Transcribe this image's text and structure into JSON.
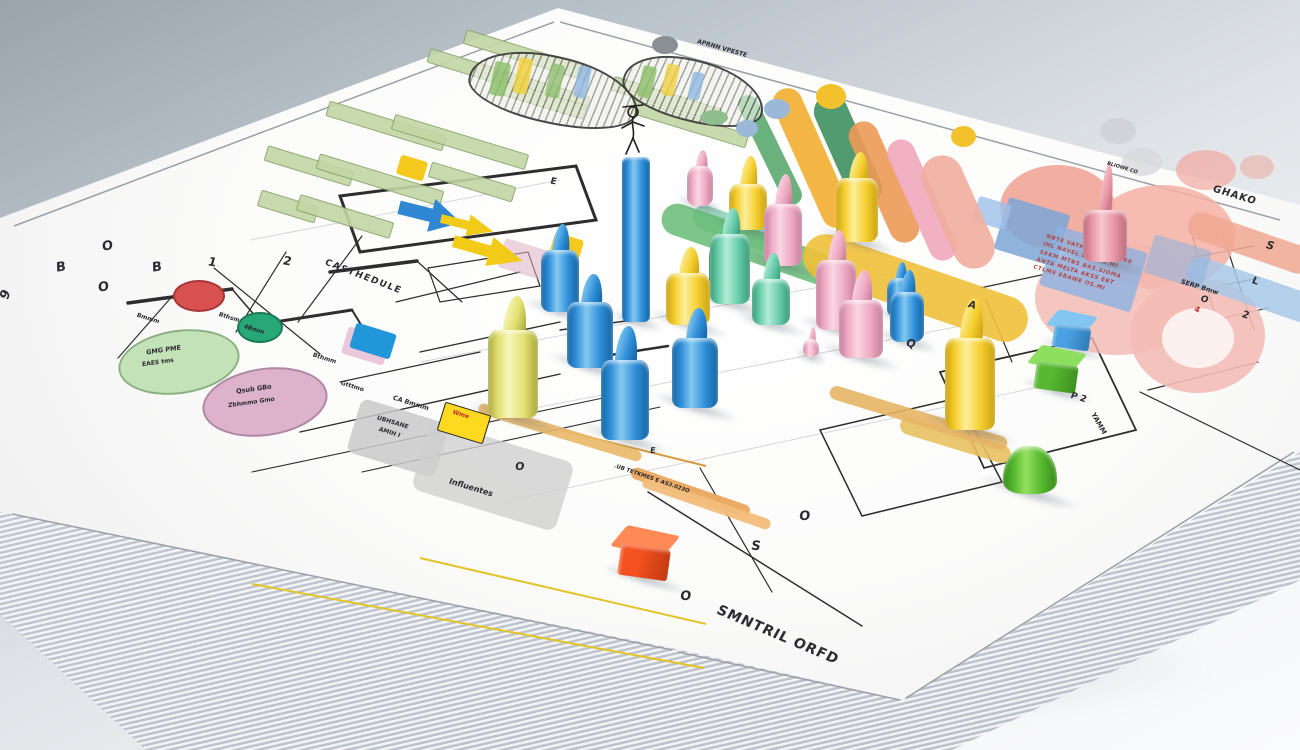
{
  "scene": {
    "description": "3D render of a stack of white papers printed with colorful project charts, Gantt bars, flowcharts and pink data blobs, covered with glossy plastic game pegs and cubes",
    "background_top": "#9aa4ad",
    "background_bottom": "#fafbfc",
    "paper_color": "#fcfcfb"
  },
  "palettes": {
    "blue": {
      "b": "#2f8fd9",
      "l": "#85c8f0",
      "d": "#1563a0"
    },
    "yellow": {
      "b": "#f5cf2e",
      "l": "#fcee9a",
      "d": "#c9a113"
    },
    "yellow2": {
      "b": "#e3e070",
      "l": "#f6f6bc",
      "d": "#aaa83e"
    },
    "pink": {
      "b": "#eeaac2",
      "l": "#fad6e2",
      "d": "#c27e9a"
    },
    "salmon": {
      "b": "#e895a5",
      "l": "#f6c6d0",
      "d": "#b86a7c"
    },
    "green": {
      "b": "#66ccaa",
      "l": "#b4ecd8",
      "d": "#3a9874"
    },
    "green2": {
      "b": "#3aa864",
      "l": "#82d4a2",
      "d": "#1f7a42"
    },
    "green3": {
      "b": "#55b82e",
      "l": "#96e060",
      "d": "#3a8c1c"
    }
  },
  "labels": [
    {
      "t": "O",
      "x": 102,
      "y": 240,
      "r": -8,
      "s": 13
    },
    {
      "t": "B",
      "x": 56,
      "y": 261,
      "r": -8,
      "s": 13
    },
    {
      "t": "B",
      "x": 152,
      "y": 261,
      "r": -8,
      "s": 13
    },
    {
      "t": "O",
      "x": 98,
      "y": 281,
      "r": -8,
      "s": 13
    },
    {
      "t": "9",
      "x": 2,
      "y": 288,
      "r": -70,
      "s": 13
    },
    {
      "t": "2",
      "x": 283,
      "y": 255,
      "r": 10,
      "s": 12
    },
    {
      "t": "1",
      "x": 208,
      "y": 256,
      "r": 10,
      "s": 12
    },
    {
      "t": "CASTHEDULE",
      "x": 322,
      "y": 273,
      "r": 21,
      "s": 9,
      "ls": 1.5
    },
    {
      "t": "Bmmm",
      "x": 136,
      "y": 316,
      "r": 17,
      "s": 6
    },
    {
      "t": "Bthsm",
      "x": 218,
      "y": 315,
      "r": 17,
      "s": 6
    },
    {
      "t": "4Bmm",
      "x": 243,
      "y": 327,
      "r": 17,
      "s": 6
    },
    {
      "t": "Bthmm",
      "x": 312,
      "y": 356,
      "r": 17,
      "s": 6
    },
    {
      "t": "Gtttmo",
      "x": 340,
      "y": 384,
      "r": 17,
      "s": 6
    },
    {
      "t": "GMG PME",
      "x": 146,
      "y": 347,
      "r": -8,
      "s": 6.5
    },
    {
      "t": "EAES tms",
      "x": 142,
      "y": 360,
      "r": -8,
      "s": 6
    },
    {
      "t": "Qsub GBo",
      "x": 236,
      "y": 386,
      "r": -8,
      "s": 6.5
    },
    {
      "t": "Zbhmmo Gmo",
      "x": 228,
      "y": 400,
      "r": -8,
      "s": 6
    },
    {
      "t": "CA Bmmm",
      "x": 392,
      "y": 400,
      "r": 17,
      "s": 6.5
    },
    {
      "t": "UBHSANE",
      "x": 376,
      "y": 420,
      "r": 17,
      "s": 6
    },
    {
      "t": "AMIH I",
      "x": 378,
      "y": 430,
      "r": 17,
      "s": 6
    },
    {
      "t": "Influentes",
      "x": 448,
      "y": 484,
      "r": 17,
      "s": 8
    },
    {
      "t": "O",
      "x": 515,
      "y": 461,
      "r": 0,
      "s": 11
    },
    {
      "t": "E",
      "x": 550,
      "y": 178,
      "r": 10,
      "s": 9
    },
    {
      "t": "APRNN VPESTE",
      "x": 696,
      "y": 46,
      "r": 16,
      "s": 6
    },
    {
      "t": ".UB TETKMES E AS3.023O",
      "x": 612,
      "y": 476,
      "r": 19,
      "s": 5.5
    },
    {
      "t": "E",
      "x": 650,
      "y": 447,
      "r": 0,
      "s": 8
    },
    {
      "t": "O",
      "x": 680,
      "y": 590,
      "r": 0,
      "s": 13
    },
    {
      "t": "S",
      "x": 751,
      "y": 540,
      "r": 5,
      "s": 13
    },
    {
      "t": "O",
      "x": 799,
      "y": 510,
      "r": 0,
      "s": 13
    },
    {
      "t": "SMNTRIL ORFD",
      "x": 712,
      "y": 628,
      "r": 23,
      "s": 14,
      "ls": 1
    },
    {
      "t": "Q",
      "x": 906,
      "y": 338,
      "r": 15,
      "s": 11
    },
    {
      "t": "A",
      "x": 968,
      "y": 300,
      "r": 15,
      "s": 10
    },
    {
      "t": "GHAKO",
      "x": 1212,
      "y": 190,
      "r": 17,
      "s": 10,
      "ls": 1
    },
    {
      "t": "BLIOWE CO",
      "x": 1106,
      "y": 166,
      "r": 17,
      "s": 5
    },
    {
      "t": "SERP Bmw",
      "x": 1180,
      "y": 284,
      "r": 17,
      "s": 6.5
    },
    {
      "t": "S",
      "x": 1266,
      "y": 240,
      "r": 17,
      "s": 11
    },
    {
      "t": "L",
      "x": 1252,
      "y": 276,
      "r": 17,
      "s": 10
    },
    {
      "t": "2",
      "x": 1242,
      "y": 310,
      "r": 17,
      "s": 10
    },
    {
      "t": "O",
      "x": 1200,
      "y": 296,
      "r": 17,
      "s": 9
    },
    {
      "t": "4",
      "x": 1194,
      "y": 306,
      "r": 17,
      "s": 8,
      "c": "#c03030"
    },
    {
      "t": "P 2",
      "x": 1070,
      "y": 394,
      "r": 17,
      "s": 9
    },
    {
      "t": "YAMM",
      "x": 1086,
      "y": 420,
      "r": 60,
      "s": 7
    },
    {
      "t": "Wme",
      "x": 452,
      "y": 412,
      "r": 17,
      "s": 6,
      "c": "#b83030"
    }
  ],
  "red_table": {
    "x": 1028,
    "y": 252,
    "w": 152,
    "h": 84,
    "r": 17,
    "rows": [
      "NBTE VATMOS OF SAMKE",
      "IHL NAVEL NVO TS.MI",
      "SEKM MTBS BAS.SIOMA",
      "ANTA MELTA AKSS EBT",
      "CTLMS EBAWE OS.MI"
    ]
  },
  "shapes": [
    {
      "T": "ell",
      "x": 1000,
      "y": 165,
      "w": 115,
      "h": 85,
      "c": "#f0a090",
      "o": 0.85
    },
    {
      "T": "ell",
      "x": 1090,
      "y": 185,
      "w": 145,
      "h": 105,
      "c": "#f4b0a4",
      "o": 0.85
    },
    {
      "T": "ell",
      "x": 1035,
      "y": 240,
      "w": 165,
      "h": 115,
      "c": "#f2b8b0",
      "o": 0.8
    },
    {
      "T": "ell",
      "x": 1130,
      "y": 278,
      "w": 135,
      "h": 115,
      "c": "#f4bcb6",
      "o": 0.9
    },
    {
      "T": "ell",
      "x": 1162,
      "y": 308,
      "w": 72,
      "h": 60,
      "c": "#fdf3f2",
      "o": 0.95
    },
    {
      "T": "ell",
      "x": 1176,
      "y": 150,
      "w": 60,
      "h": 40,
      "c": "#f2a8a0",
      "o": 0.7
    },
    {
      "T": "ell",
      "x": 1122,
      "y": 148,
      "w": 40,
      "h": 28,
      "c": "#d8d8dc",
      "o": 0.8
    },
    {
      "T": "ell",
      "x": 1100,
      "y": 118,
      "w": 36,
      "h": 26,
      "c": "#cfcfd4",
      "o": 0.8
    },
    {
      "T": "ell",
      "x": 1240,
      "y": 155,
      "w": 34,
      "h": 24,
      "c": "#e8b8b0",
      "o": 0.7
    },
    {
      "T": "cap",
      "x": 1250,
      "y": 243,
      "l": 130,
      "t": 28,
      "r": 19,
      "c": "#f0a890",
      "o": 0.85
    },
    {
      "T": "cap",
      "x": 1258,
      "y": 292,
      "l": 150,
      "t": 30,
      "r": 19,
      "c": "#a8c8e8",
      "o": 0.85
    },
    {
      "T": "rect",
      "x": 1000,
      "y": 205,
      "w": 64,
      "h": 54,
      "r": 17,
      "c": "#7ca6d6",
      "o": 0.85
    },
    {
      "T": "rect",
      "x": 1046,
      "y": 238,
      "w": 95,
      "h": 62,
      "r": 17,
      "c": "#8cb2e2",
      "o": 0.8
    },
    {
      "T": "rect",
      "x": 975,
      "y": 200,
      "w": 34,
      "h": 26,
      "r": 17,
      "c": "#9ec0e8",
      "o": 0.8
    },
    {
      "T": "rect",
      "x": 1148,
      "y": 242,
      "w": 60,
      "h": 40,
      "r": 17,
      "c": "#92b4dc",
      "o": 0.6
    },
    {
      "T": "cap",
      "x": 770,
      "y": 150,
      "l": 120,
      "t": 20,
      "r": 64,
      "c": "#5aa96f",
      "o": 0.9
    },
    {
      "T": "cap",
      "x": 812,
      "y": 158,
      "l": 150,
      "t": 30,
      "r": 66,
      "c": "#f2b23a",
      "o": 0.95
    },
    {
      "T": "cap",
      "x": 848,
      "y": 150,
      "l": 118,
      "t": 34,
      "r": 66,
      "c": "#3f8f5f",
      "o": 0.9
    },
    {
      "T": "cap",
      "x": 884,
      "y": 182,
      "l": 130,
      "t": 30,
      "r": 66,
      "c": "#ec9a57",
      "o": 0.9
    },
    {
      "T": "cap",
      "x": 922,
      "y": 200,
      "l": 130,
      "t": 28,
      "r": 66,
      "c": "#f0a8bc",
      "o": 0.9
    },
    {
      "T": "cap",
      "x": 958,
      "y": 212,
      "l": 120,
      "t": 42,
      "r": 66,
      "c": "#efae9e",
      "o": 0.9
    },
    {
      "T": "cap",
      "x": 745,
      "y": 232,
      "l": 110,
      "t": 24,
      "r": 20,
      "c": "#8fd0b8",
      "o": 0.85
    },
    {
      "T": "cap",
      "x": 757,
      "y": 247,
      "l": 200,
      "t": 32,
      "r": 19,
      "c": "#66bb73",
      "o": 0.85
    },
    {
      "T": "cap",
      "x": 915,
      "y": 288,
      "l": 235,
      "t": 46,
      "r": 19,
      "c": "#f0c03a",
      "o": 0.9
    },
    {
      "T": "cap",
      "x": 955,
      "y": 440,
      "l": 115,
      "t": 18,
      "r": 17,
      "c": "#e8c060",
      "o": 0.9
    },
    {
      "T": "cap",
      "x": 918,
      "y": 418,
      "l": 185,
      "t": 14,
      "r": 17,
      "c": "#e7b565",
      "o": 0.9
    },
    {
      "T": "cap",
      "x": 690,
      "y": 492,
      "l": 125,
      "t": 12,
      "r": 19,
      "c": "#eaa75c",
      "o": 0.95
    },
    {
      "T": "cap",
      "x": 706,
      "y": 503,
      "l": 135,
      "t": 11,
      "r": 19,
      "c": "#f2bd7a",
      "o": 0.95
    },
    {
      "T": "cap",
      "x": 560,
      "y": 432,
      "l": 170,
      "t": 11,
      "r": 17,
      "c": "#eab868",
      "o": 0.9
    },
    {
      "T": "bar",
      "x": 462,
      "y": 48,
      "w": 128,
      "h": 13
    },
    {
      "T": "bar",
      "x": 425,
      "y": 72,
      "w": 165,
      "h": 13
    },
    {
      "T": "bar",
      "x": 497,
      "y": 92,
      "w": 88,
      "h": 13
    },
    {
      "T": "bar",
      "x": 325,
      "y": 118,
      "w": 120,
      "h": 14
    },
    {
      "T": "bar",
      "x": 390,
      "y": 134,
      "w": 138,
      "h": 14
    },
    {
      "T": "bar",
      "x": 264,
      "y": 158,
      "w": 88,
      "h": 14
    },
    {
      "T": "bar",
      "x": 315,
      "y": 172,
      "w": 128,
      "h": 14
    },
    {
      "T": "bar",
      "x": 428,
      "y": 174,
      "w": 86,
      "h": 14
    },
    {
      "T": "bar",
      "x": 258,
      "y": 198,
      "w": 58,
      "h": 15
    },
    {
      "T": "bar",
      "x": 296,
      "y": 208,
      "w": 96,
      "h": 15
    },
    {
      "T": "bar",
      "x": 610,
      "y": 92,
      "w": 110,
      "h": 13
    },
    {
      "T": "bar",
      "x": 628,
      "y": 116,
      "w": 120,
      "h": 13
    },
    {
      "T": "hatch",
      "x": 468,
      "y": 56,
      "w": 168,
      "h": 64,
      "r": 12
    },
    {
      "T": "hatch",
      "x": 622,
      "y": 60,
      "w": 140,
      "h": 58,
      "r": 14
    },
    {
      "T": "rect",
      "x": 492,
      "y": 62,
      "w": 16,
      "h": 34,
      "r": 12,
      "c": "#8fbf6f",
      "o": 0.85
    },
    {
      "T": "rect",
      "x": 516,
      "y": 58,
      "w": 14,
      "h": 36,
      "r": 12,
      "c": "#f0d040",
      "o": 0.85
    },
    {
      "T": "rect",
      "x": 548,
      "y": 64,
      "w": 14,
      "h": 34,
      "r": 12,
      "c": "#8fbf6f",
      "o": 0.8
    },
    {
      "T": "rect",
      "x": 576,
      "y": 66,
      "w": 13,
      "h": 32,
      "r": 12,
      "c": "#90b8e0",
      "o": 0.8
    },
    {
      "T": "rect",
      "x": 640,
      "y": 66,
      "w": 14,
      "h": 32,
      "r": 13,
      "c": "#8fbf6f",
      "o": 0.85
    },
    {
      "T": "rect",
      "x": 664,
      "y": 64,
      "w": 13,
      "h": 32,
      "r": 13,
      "c": "#f0d040",
      "o": 0.8
    },
    {
      "T": "rect",
      "x": 690,
      "y": 72,
      "w": 12,
      "h": 28,
      "r": 13,
      "c": "#90b8e0",
      "o": 0.8
    },
    {
      "T": "ell",
      "x": 652,
      "y": 36,
      "w": 26,
      "h": 18,
      "c": "#8a8f94",
      "o": 1
    },
    {
      "T": "ell",
      "x": 816,
      "y": 84,
      "w": 30,
      "h": 25,
      "c": "#f2c12c",
      "o": 1
    },
    {
      "T": "ell",
      "x": 951,
      "y": 126,
      "w": 25,
      "h": 21,
      "c": "#f2c12c",
      "o": 1
    },
    {
      "T": "ell",
      "x": 764,
      "y": 99,
      "w": 26,
      "h": 20,
      "c": "#9ab8d8",
      "o": 1
    },
    {
      "T": "ell",
      "x": 736,
      "y": 120,
      "w": 22,
      "h": 17,
      "c": "#9ab8d8",
      "o": 1
    },
    {
      "T": "ell",
      "x": 700,
      "y": 110,
      "w": 28,
      "h": 15,
      "c": "#8fbf8f",
      "o": 1
    },
    {
      "T": "ell",
      "x": 173,
      "y": 280,
      "w": 48,
      "h": 28,
      "c": "#d85050",
      "bc": "#a83838",
      "o": 1
    },
    {
      "T": "ell",
      "x": 237,
      "y": 312,
      "w": 42,
      "h": 27,
      "c": "#28a878",
      "bc": "#1a7a56",
      "o": 1
    },
    {
      "T": "ell",
      "x": 118,
      "y": 330,
      "w": 118,
      "h": 60,
      "c": "#c4e2b8",
      "bc": "#8cb080",
      "o": 1,
      "rr": -8
    },
    {
      "T": "ell",
      "x": 202,
      "y": 368,
      "w": 122,
      "h": 64,
      "c": "#dcb2cc",
      "bc": "#b088a4",
      "o": 1,
      "rr": -8
    },
    {
      "T": "rect",
      "x": 500,
      "y": 246,
      "w": 60,
      "h": 30,
      "r": 17,
      "c": "#dcb0c4",
      "o": 0.55
    },
    {
      "T": "rect",
      "x": 344,
      "y": 332,
      "w": 44,
      "h": 28,
      "r": 17,
      "c": "#e8c2d6",
      "o": 0.9
    },
    {
      "T": "rect",
      "x": 352,
      "y": 328,
      "w": 42,
      "h": 26,
      "r": 17,
      "c": "#2196d9",
      "o": 1
    },
    {
      "T": "rect",
      "x": 352,
      "y": 410,
      "w": 92,
      "h": 56,
      "r": 17,
      "c": "#c9c9c9",
      "o": 0.85,
      "rad": 8
    },
    {
      "T": "rect",
      "x": 418,
      "y": 440,
      "w": 150,
      "h": 72,
      "r": 17,
      "c": "#cfcfcf",
      "o": 0.8,
      "rad": 10
    },
    {
      "T": "rect",
      "x": 398,
      "y": 158,
      "w": 28,
      "h": 20,
      "r": 17,
      "c": "#f6c91e",
      "o": 1
    },
    {
      "T": "rect",
      "x": 552,
      "y": 236,
      "w": 30,
      "h": 20,
      "r": 17,
      "c": "#f6c91e",
      "o": 1
    },
    {
      "T": "tag",
      "x": 440,
      "y": 408,
      "w": 46,
      "h": 28,
      "r": 17,
      "c": "#ffd920",
      "o": 1
    },
    {
      "T": "arrow",
      "x": 398,
      "y": 198,
      "w": 64,
      "h": 34,
      "r": 14,
      "c": "#2f86d2",
      "o": 1
    },
    {
      "T": "arrow",
      "x": 440,
      "y": 214,
      "w": 54,
      "h": 22,
      "r": 14,
      "c": "#f2ca18",
      "o": 1
    },
    {
      "T": "arrow",
      "x": 452,
      "y": 236,
      "w": 72,
      "h": 30,
      "r": 16,
      "c": "#f2ca18",
      "o": 1
    }
  ],
  "pieces": [
    {
      "k": "peg",
      "x": 700,
      "y": 206,
      "w": 26,
      "h": 40,
      "tip": 16,
      "c": "pink"
    },
    {
      "k": "peg",
      "x": 748,
      "y": 230,
      "w": 38,
      "h": 46,
      "tip": 28,
      "c": "yellow"
    },
    {
      "k": "peg",
      "x": 857,
      "y": 242,
      "w": 42,
      "h": 64,
      "tip": 26,
      "c": "yellow"
    },
    {
      "k": "peg",
      "x": 1105,
      "y": 262,
      "w": 44,
      "h": 52,
      "tip": 46,
      "c": "salmon",
      "thin": true
    },
    {
      "k": "peg",
      "x": 783,
      "y": 266,
      "w": 38,
      "h": 62,
      "tip": 30,
      "c": "pink"
    },
    {
      "k": "peg",
      "x": 720,
      "y": 288,
      "w": 22,
      "h": 44,
      "tip": 18,
      "c": "green2"
    },
    {
      "k": "peg",
      "x": 730,
      "y": 304,
      "w": 40,
      "h": 70,
      "tip": 26,
      "c": "green"
    },
    {
      "k": "peg",
      "x": 560,
      "y": 312,
      "w": 38,
      "h": 62,
      "tip": 26,
      "c": "blue"
    },
    {
      "k": "peg",
      "x": 899,
      "y": 318,
      "w": 24,
      "h": 40,
      "tip": 16,
      "c": "blue"
    },
    {
      "k": "peg",
      "x": 636,
      "y": 322,
      "w": 28,
      "h": 165,
      "tip": 0,
      "c": "blue",
      "fig": true
    },
    {
      "k": "peg",
      "x": 688,
      "y": 325,
      "w": 44,
      "h": 52,
      "tip": 26,
      "c": "yellow"
    },
    {
      "k": "peg",
      "x": 771,
      "y": 325,
      "w": 38,
      "h": 46,
      "tip": 26,
      "c": "green"
    },
    {
      "k": "peg",
      "x": 836,
      "y": 330,
      "w": 40,
      "h": 70,
      "tip": 30,
      "c": "pink"
    },
    {
      "k": "peg",
      "x": 907,
      "y": 342,
      "w": 34,
      "h": 50,
      "tip": 22,
      "c": "blue"
    },
    {
      "k": "cube",
      "x": 1072,
      "y": 350,
      "s": 40,
      "c": "#4aa0e0",
      "lt": "#83c6f2",
      "dk": "#2f7ab8"
    },
    {
      "k": "peg",
      "x": 811,
      "y": 357,
      "w": 16,
      "h": 18,
      "tip": 12,
      "c": "pink"
    },
    {
      "k": "peg",
      "x": 861,
      "y": 358,
      "w": 44,
      "h": 58,
      "tip": 30,
      "c": "pink"
    },
    {
      "k": "peg",
      "x": 590,
      "y": 368,
      "w": 46,
      "h": 66,
      "tip": 28,
      "c": "blue"
    },
    {
      "k": "cube",
      "x": 1057,
      "y": 392,
      "s": 46,
      "c": "#58b832",
      "lt": "#8ede5f",
      "dk": "#3d8f1f"
    },
    {
      "k": "peg",
      "x": 695,
      "y": 408,
      "w": 46,
      "h": 70,
      "tip": 30,
      "c": "blue"
    },
    {
      "k": "peg",
      "x": 513,
      "y": 418,
      "w": 50,
      "h": 88,
      "tip": 34,
      "c": "yellow2"
    },
    {
      "k": "peg",
      "x": 970,
      "y": 430,
      "w": 50,
      "h": 92,
      "tip": 40,
      "c": "yellow"
    },
    {
      "k": "peg",
      "x": 625,
      "y": 440,
      "w": 48,
      "h": 80,
      "tip": 34,
      "c": "blue"
    },
    {
      "k": "dome",
      "x": 1030,
      "y": 494,
      "w": 54,
      "h": 48,
      "c": "green3"
    },
    {
      "k": "cube",
      "x": 645,
      "y": 580,
      "s": 54,
      "c": "#f3511e",
      "lt": "#ff8a55",
      "dk": "#c23a12"
    }
  ],
  "gantt_bar_color": "#c3d6a6",
  "gantt_bar_border": "#86a468"
}
